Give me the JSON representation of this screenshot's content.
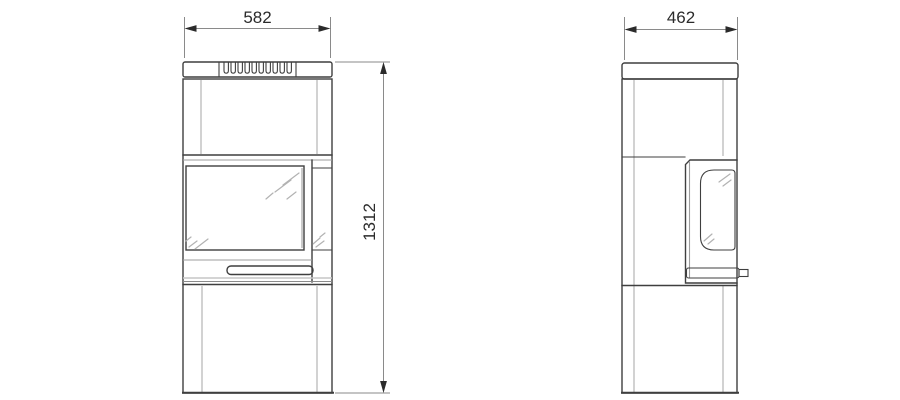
{
  "drawing": {
    "type": "technical-drawing",
    "views": [
      "front-view",
      "side-view"
    ],
    "dimensions": {
      "front_width": "582",
      "side_depth": "462",
      "height": "1312"
    }
  },
  "colors": {
    "background": "#ffffff",
    "outline": "#3f3f3f",
    "seam": "#c6c6c6",
    "mid_line": "#9e9e9e",
    "glass_mark": "#b2b2b2",
    "dimension_line": "#8a8a8a",
    "dimension_text": "#2b2b2b"
  }
}
